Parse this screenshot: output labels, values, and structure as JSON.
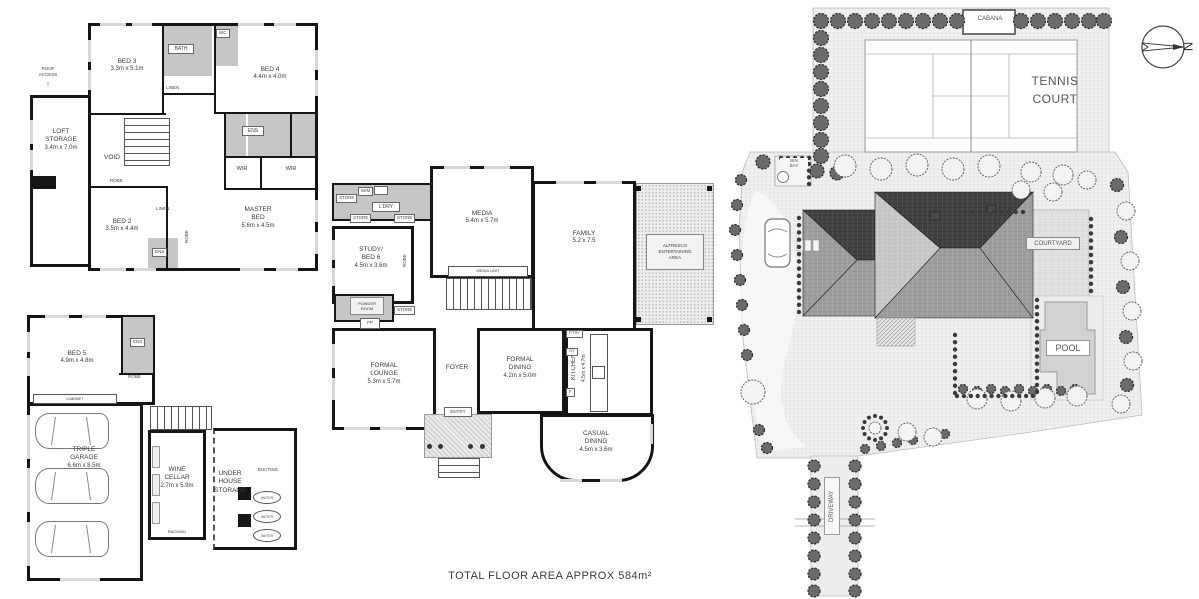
{
  "footer": "TOTAL FLOOR AREA APPROX  584m²",
  "compass": {
    "north": "N"
  },
  "upper_floor": {
    "roof_access": "ROOF\nACCESS",
    "loft": {
      "name": "LOFT\nSTORAGE",
      "dims": "3.4m x 7.0m"
    },
    "bed3": {
      "name": "BED 3",
      "dims": "3.3m x 5.1m"
    },
    "bath": "BATH",
    "wc": "WC",
    "bed4": {
      "name": "BED 4",
      "dims": "4.4m x 4.0m"
    },
    "linen": "LINEN",
    "void": "VOID",
    "ens": "ENS",
    "wir": "WIR",
    "robe": "ROBE",
    "bed2": {
      "name": "BED 2",
      "dims": "3.5m x 4.4m"
    },
    "master": {
      "name": "MASTER\nBED",
      "dims": "5.6m x 4.5m"
    }
  },
  "ground_floor": {
    "store": "STORE",
    "wm": "W/M",
    "ldry": "L'DRY",
    "media": {
      "name": "MEDIA",
      "dims": "5.4m x 5.7m"
    },
    "media_unit": "MEDIA UNIT",
    "family": {
      "name": "FAMILY",
      "dims": "5.2 x 7.5"
    },
    "alfresco": "ALFRESCO\nENTERTAINING\nAREA",
    "study": {
      "name": "STUDY/\nBED 6",
      "dims": "4.5m x 3.6m"
    },
    "robe": "ROBE",
    "powder": "POWDER\nROOM",
    "fp": "FP",
    "lounge": {
      "name": "FORMAL\nLOUNGE",
      "dims": "5.3m x 5.7m"
    },
    "foyer": "FOYER",
    "entry": "ENTRY",
    "dining": {
      "name": "FORMAL\nDINING",
      "dims": "4.2m x 5.0m"
    },
    "kitchen": {
      "name": "KITCHEN",
      "dims": "4.5m x 4.7m"
    },
    "ptry": "P'TRY",
    "ov": "OV",
    "fridge": "F",
    "casual": {
      "name": "CASUAL\nDINING",
      "dims": "4.5m x 3.6m"
    }
  },
  "garage_floor": {
    "bed5": {
      "name": "BED 5",
      "dims": "4.9m x 4.8m"
    },
    "ens": "ENS",
    "robe": "ROBE",
    "cabinet": "CABINET",
    "garage": {
      "name": "TRIPLE\nGARAGE",
      "dims": "6.6m x 8.5m"
    },
    "wine": {
      "name": "WINE\nCELLAR",
      "dims": "2.7m x 5.9m"
    },
    "racking": "RACKING",
    "storage": "UNDER\nHOUSE\nSTORAGE",
    "ducting": "DUCTING",
    "water": "WATER"
  },
  "site_plan": {
    "cabana": "CABANA",
    "tennis_court": "TENNIS\nCOURT",
    "bin_bay": "BIN\nBAY",
    "courtyard": "COURTYARD",
    "pool": "POOL",
    "driveway": "DRIVEWAY"
  }
}
